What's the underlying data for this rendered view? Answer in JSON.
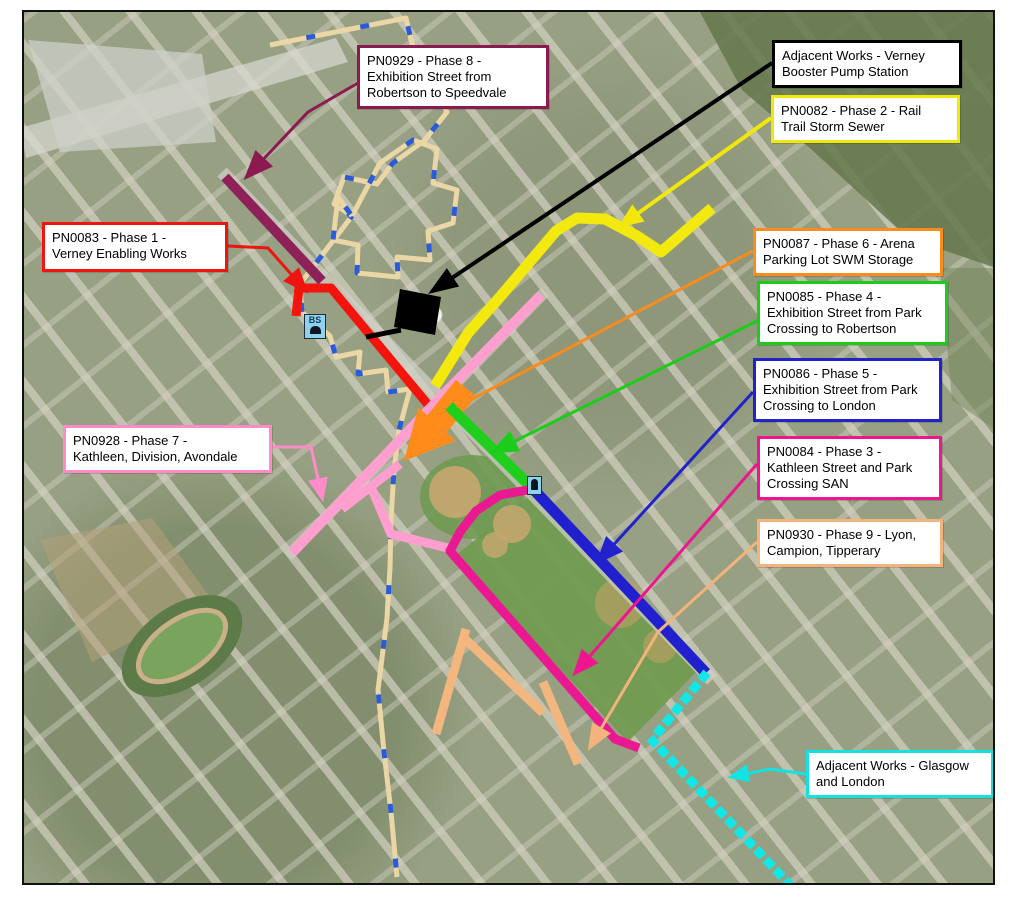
{
  "map": {
    "title": "Construction phasing key map",
    "frame_color": "#111111",
    "basemap_name": "aerial-photo"
  },
  "annotations": [
    {
      "id": "phase8",
      "label": "PN0929 - Phase 8 -\nExhibition Street from\nRobertson to Speedvale",
      "color": "#8B1A50",
      "box": {
        "x": 357,
        "y": 45,
        "w": 192,
        "h": 62
      },
      "leader": [
        [
          358,
          83
        ],
        [
          308,
          112
        ],
        [
          256,
          167
        ]
      ],
      "head": {
        "len": 30,
        "wid": 24
      }
    },
    {
      "id": "adjacent-verney",
      "label": "Adjacent Works - Verney\nBooster Pump Station",
      "color": "#000000",
      "box": {
        "x": 772,
        "y": 40,
        "w": 190,
        "h": 47
      },
      "leader": [
        [
          772,
          63
        ],
        [
          443,
          284
        ]
      ],
      "lw": 4,
      "head": {
        "len": 30,
        "wid": 22
      }
    },
    {
      "id": "phase2",
      "label": "PN0082 - Phase 2 - Rail\nTrail Storm Sewer",
      "color": "#F2E70A",
      "box": {
        "x": 771,
        "y": 95,
        "w": 189,
        "h": 46
      },
      "leader": [
        [
          771,
          118
        ],
        [
          630,
          219
        ]
      ],
      "lw": 4,
      "head": {
        "len": 26,
        "wid": 21
      }
    },
    {
      "id": "phase1",
      "label": "PN0083 - Phase 1 -\nVerney Enabling Works",
      "color": "#EE1410",
      "box": {
        "x": 42,
        "y": 222,
        "w": 186,
        "h": 50
      },
      "leader": [
        [
          228,
          246
        ],
        [
          268,
          248
        ],
        [
          298,
          282
        ]
      ],
      "head": {
        "len": 26,
        "wid": 21
      }
    },
    {
      "id": "phase6",
      "label": "PN0087 - Phase 6 - Arena\nParking Lot SWM Storage",
      "color": "#F98C1E",
      "box": {
        "x": 753,
        "y": 228,
        "w": 190,
        "h": 46
      },
      "leader": [
        [
          753,
          251
        ],
        [
          457,
          407
        ]
      ],
      "no_head": true
    },
    {
      "id": "phase4",
      "label": "PN0085 - Phase 4 -\nExhibition Street from Park\nCrossing to Robertson",
      "color": "#1BCC1B",
      "box": {
        "x": 757,
        "y": 281,
        "w": 191,
        "h": 63
      },
      "leader": [
        [
          757,
          321
        ],
        [
          505,
          446
        ]
      ],
      "head": {
        "len": 28,
        "wid": 23
      }
    },
    {
      "id": "phase5",
      "label": "PN0086 - Phase 5 -\nExhibition Street from Park\nCrossing to London",
      "color": "#2222CC",
      "box": {
        "x": 753,
        "y": 358,
        "w": 189,
        "h": 62
      },
      "leader": [
        [
          753,
          392
        ],
        [
          607,
          552
        ]
      ],
      "head": {
        "len": 28,
        "wid": 23
      }
    },
    {
      "id": "phase3",
      "label": "PN0084 - Phase 3 -\nKathleen Street and Park\nCrossing SAN",
      "color": "#ED1690",
      "box": {
        "x": 757,
        "y": 436,
        "w": 185,
        "h": 61
      },
      "leader": [
        [
          757,
          464
        ],
        [
          583,
          664
        ]
      ],
      "head": {
        "len": 27,
        "wid": 22
      }
    },
    {
      "id": "phase9",
      "label": "PN0930 - Phase 9 - Lyon,\nCampion, Tipperary",
      "color": "#F2B37C",
      "box": {
        "x": 757,
        "y": 519,
        "w": 186,
        "h": 47
      },
      "leader": [
        [
          757,
          542
        ],
        [
          658,
          632
        ],
        [
          596,
          737
        ]
      ],
      "head": {
        "len": 27,
        "wid": 22
      }
    },
    {
      "id": "phase7",
      "label": "PN0928 - Phase 7 -\nKathleen, Division, Avondale",
      "color": "#FF8CC8",
      "box": {
        "x": 63,
        "y": 425,
        "w": 209,
        "h": 46
      },
      "leader": [
        [
          272,
          447
        ],
        [
          311,
          447
        ],
        [
          320,
          488
        ]
      ],
      "head": {
        "len": 24,
        "wid": 20
      }
    },
    {
      "id": "adjacent-glasgow",
      "label": "Adjacent Works - Glasgow\nand London",
      "color": "#12E2E2",
      "box": {
        "x": 806,
        "y": 750,
        "w": 188,
        "h": 46
      },
      "leader": [
        [
          806,
          774
        ],
        [
          770,
          769
        ],
        [
          740,
          775
        ]
      ],
      "head": {
        "len": 22,
        "wid": 18
      }
    }
  ],
  "routes": [
    {
      "id": "route-watermain-boundary",
      "color": "#EBD6A6",
      "width": 5,
      "points": [
        [
          270,
          45
        ],
        [
          406,
          18
        ],
        [
          412,
          44
        ],
        [
          447,
          112
        ],
        [
          424,
          141
        ],
        [
          393,
          163
        ],
        [
          377,
          184
        ],
        [
          344,
          177
        ],
        [
          334,
          204
        ],
        [
          352,
          216
        ],
        [
          300,
          284
        ],
        [
          302,
          312
        ],
        [
          330,
          336
        ],
        [
          336,
          357
        ],
        [
          360,
          352
        ],
        [
          358,
          374
        ],
        [
          386,
          370
        ],
        [
          388,
          392
        ],
        [
          410,
          389
        ],
        [
          399,
          430
        ],
        [
          394,
          470
        ],
        [
          391,
          520
        ],
        [
          390,
          568
        ],
        [
          387,
          618
        ],
        [
          378,
          690
        ],
        [
          384,
          752
        ],
        [
          391,
          812
        ],
        [
          397,
          877
        ]
      ],
      "overlay_dash": {
        "color": "#2A5BD8",
        "dash": "9 46"
      }
    },
    {
      "id": "route-watermain-loop",
      "color": "#EBD6A6",
      "width": 5,
      "points": [
        [
          352,
          216
        ],
        [
          380,
          163
        ],
        [
          413,
          140
        ],
        [
          437,
          149
        ],
        [
          433,
          183
        ],
        [
          457,
          190
        ],
        [
          453,
          223
        ],
        [
          428,
          231
        ],
        [
          430,
          260
        ],
        [
          397,
          257
        ],
        [
          398,
          277
        ],
        [
          357,
          273
        ],
        [
          358,
          245
        ],
        [
          333,
          240
        ],
        [
          338,
          197
        ],
        [
          352,
          216
        ]
      ],
      "overlay_dash": {
        "color": "#2A5BD8",
        "dash": "9 46"
      }
    },
    {
      "id": "route-phase2-rail-trail-storm-sewer",
      "color": "#F3E90F",
      "width": 11,
      "points": [
        [
          712,
          208
        ],
        [
          661,
          252
        ],
        [
          637,
          236
        ],
        [
          605,
          219
        ],
        [
          577,
          218
        ],
        [
          556,
          231
        ],
        [
          500,
          297
        ],
        [
          468,
          333
        ],
        [
          435,
          386
        ]
      ]
    },
    {
      "id": "route-phase8-exhibition-north",
      "color": "#8E2158",
      "width": 10,
      "points": [
        [
          225,
          177
        ],
        [
          322,
          281
        ]
      ]
    },
    {
      "id": "route-phase1-verney-enabling",
      "color": "#F3150D",
      "width": 9,
      "points": [
        [
          296,
          316
        ],
        [
          299,
          288
        ],
        [
          331,
          288
        ],
        [
          440,
          419
        ]
      ]
    },
    {
      "id": "route-phase7-kathleen-main",
      "color": "#FF9FD0",
      "width": 10,
      "points": [
        [
          541,
          295
        ],
        [
          436,
          402
        ],
        [
          292,
          553
        ]
      ]
    },
    {
      "id": "route-phase7-division-cross",
      "color": "#FF9FD0",
      "width": 9,
      "points": [
        [
          342,
          509
        ],
        [
          400,
          464
        ]
      ]
    },
    {
      "id": "route-phase7-branch",
      "color": "#FF9FD0",
      "width": 9,
      "points": [
        [
          371,
          487
        ],
        [
          391,
          534
        ],
        [
          452,
          549
        ]
      ]
    },
    {
      "id": "route-phase6-arena-swm",
      "type": "fat_arrow",
      "color": "#FF8C1A",
      "width": 26,
      "points": [
        [
          466,
          388
        ],
        [
          437,
          424
        ]
      ],
      "tip": [
        404,
        461
      ],
      "head_w": 50
    },
    {
      "id": "route-phase4-exhibition-mid",
      "color": "#1ECF1E",
      "width": 11,
      "points": [
        [
          449,
          406
        ],
        [
          533,
          489
        ]
      ]
    },
    {
      "id": "route-phase3-park-crossing-san",
      "color": "#EB1991",
      "width": 9,
      "points": [
        [
          533,
          489
        ],
        [
          500,
          495
        ],
        [
          476,
          511
        ],
        [
          460,
          532
        ],
        [
          450,
          551
        ],
        [
          615,
          739
        ],
        [
          639,
          748
        ]
      ]
    },
    {
      "id": "route-phase5-exhibition-south",
      "color": "#2020CF",
      "width": 11,
      "points": [
        [
          535,
          491
        ],
        [
          706,
          673
        ]
      ]
    },
    {
      "id": "route-phase9-lyon",
      "color": "#F4B67F",
      "width": 9,
      "points": [
        [
          466,
          629
        ],
        [
          436,
          734
        ]
      ]
    },
    {
      "id": "route-phase9-campion",
      "color": "#F4B67F",
      "width": 9,
      "points": [
        [
          463,
          637
        ],
        [
          543,
          713
        ]
      ]
    },
    {
      "id": "route-phase9-tipperary",
      "color": "#F4B67F",
      "width": 9,
      "points": [
        [
          543,
          682
        ],
        [
          578,
          764
        ]
      ]
    },
    {
      "id": "route-adjacent-glasgow-london",
      "color": "#10E8E8",
      "width": 9,
      "dash": "1 13",
      "linecap": "square",
      "points": [
        [
          704,
          676
        ],
        [
          652,
          740
        ],
        [
          790,
          885
        ]
      ]
    }
  ],
  "structures": [
    {
      "id": "verney-booster-pump-station",
      "color": "#000000",
      "polygon": [
        [
          400,
          289
        ],
        [
          441,
          297
        ],
        [
          435,
          335
        ],
        [
          394,
          327
        ]
      ],
      "stub": [
        [
          366,
          337
        ],
        [
          401,
          330
        ]
      ]
    }
  ],
  "icons": [
    {
      "id": "booster-station-icon",
      "label": "BS",
      "x": 304,
      "y": 314,
      "w": 22,
      "h": 25,
      "kind": "bs"
    },
    {
      "id": "park-crossing-icon",
      "label": "",
      "x": 527,
      "y": 476,
      "w": 15,
      "h": 19,
      "kind": "small"
    }
  ]
}
